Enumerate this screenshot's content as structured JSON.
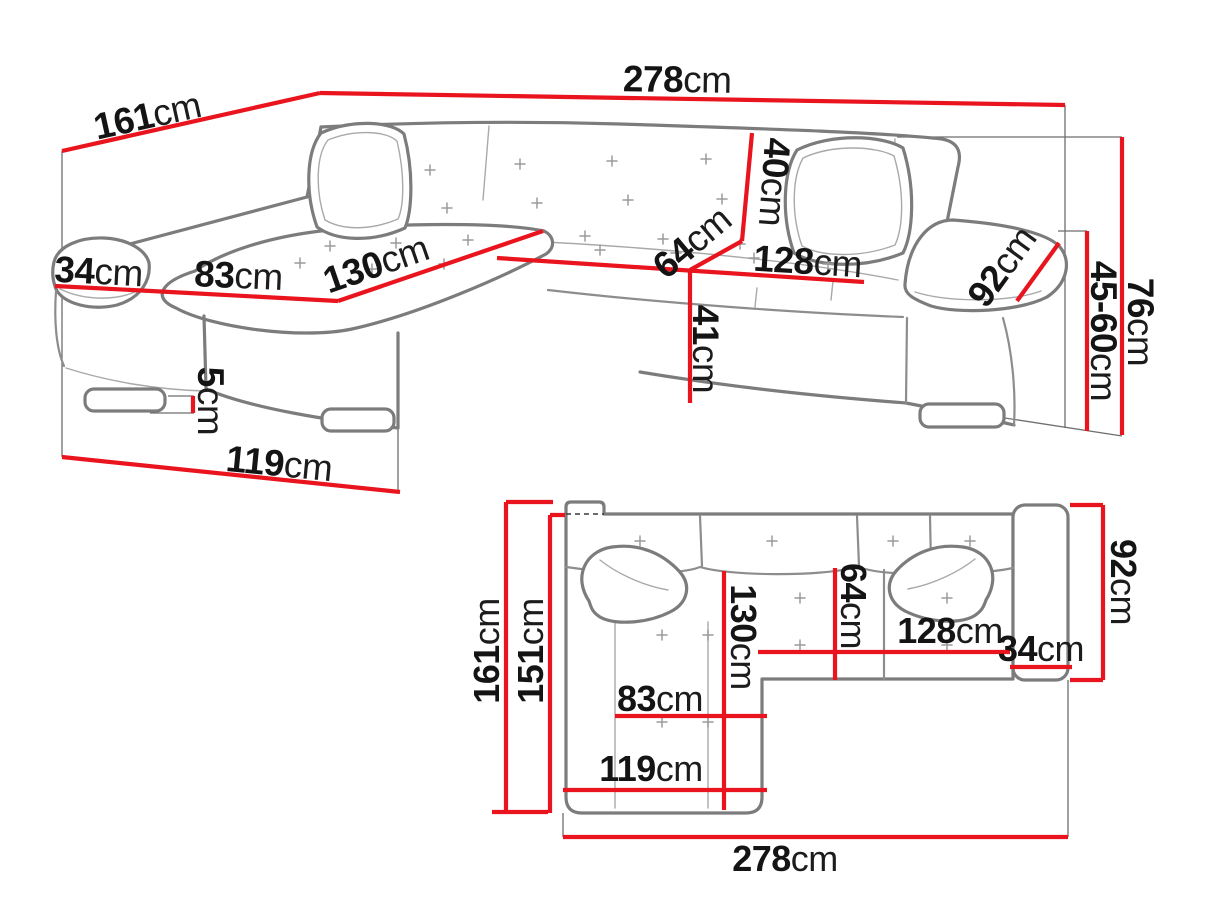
{
  "colors": {
    "dimension_line": "#e9141d",
    "sofa_outline": "#7c7c7c",
    "label_text": "#141414",
    "background": "#ffffff"
  },
  "perspective_view": {
    "description": "corner sofa perspective view with dimensions",
    "dimensions": {
      "depth": {
        "value": "161",
        "unit": "cm"
      },
      "width": {
        "value": "278",
        "unit": "cm"
      },
      "armrest_width": {
        "value": "34",
        "unit": "cm"
      },
      "chaise_seat": {
        "value": "83",
        "unit": "cm"
      },
      "chaise_length": {
        "value": "130",
        "unit": "cm"
      },
      "backrest_height": {
        "value": "40",
        "unit": "cm"
      },
      "seat_depth": {
        "value": "64",
        "unit": "cm"
      },
      "seat_width": {
        "value": "128",
        "unit": "cm"
      },
      "armrest_length": {
        "value": "92",
        "unit": "cm"
      },
      "seat_height": {
        "value": "41",
        "unit": "cm"
      },
      "leg_height": {
        "value": "5",
        "unit": "cm"
      },
      "chaise_front": {
        "value": "119",
        "unit": "cm"
      },
      "total_height": {
        "value": "76",
        "unit": "cm"
      },
      "armrest_height": {
        "value": "45-60",
        "unit": "cm"
      }
    }
  },
  "plan_view": {
    "description": "corner sofa top-down plan view with dimensions",
    "dimensions": {
      "total_depth": {
        "value": "161",
        "unit": "cm"
      },
      "chaise_depth": {
        "value": "151",
        "unit": "cm"
      },
      "chaise_length": {
        "value": "130",
        "unit": "cm"
      },
      "seat_depth": {
        "value": "64",
        "unit": "cm"
      },
      "seat_width": {
        "value": "128",
        "unit": "cm"
      },
      "armrest_width": {
        "value": "34",
        "unit": "cm"
      },
      "side_depth": {
        "value": "92",
        "unit": "cm"
      },
      "chaise_seat": {
        "value": "83",
        "unit": "cm"
      },
      "chaise_front": {
        "value": "119",
        "unit": "cm"
      },
      "total_width": {
        "value": "278",
        "unit": "cm"
      }
    }
  }
}
